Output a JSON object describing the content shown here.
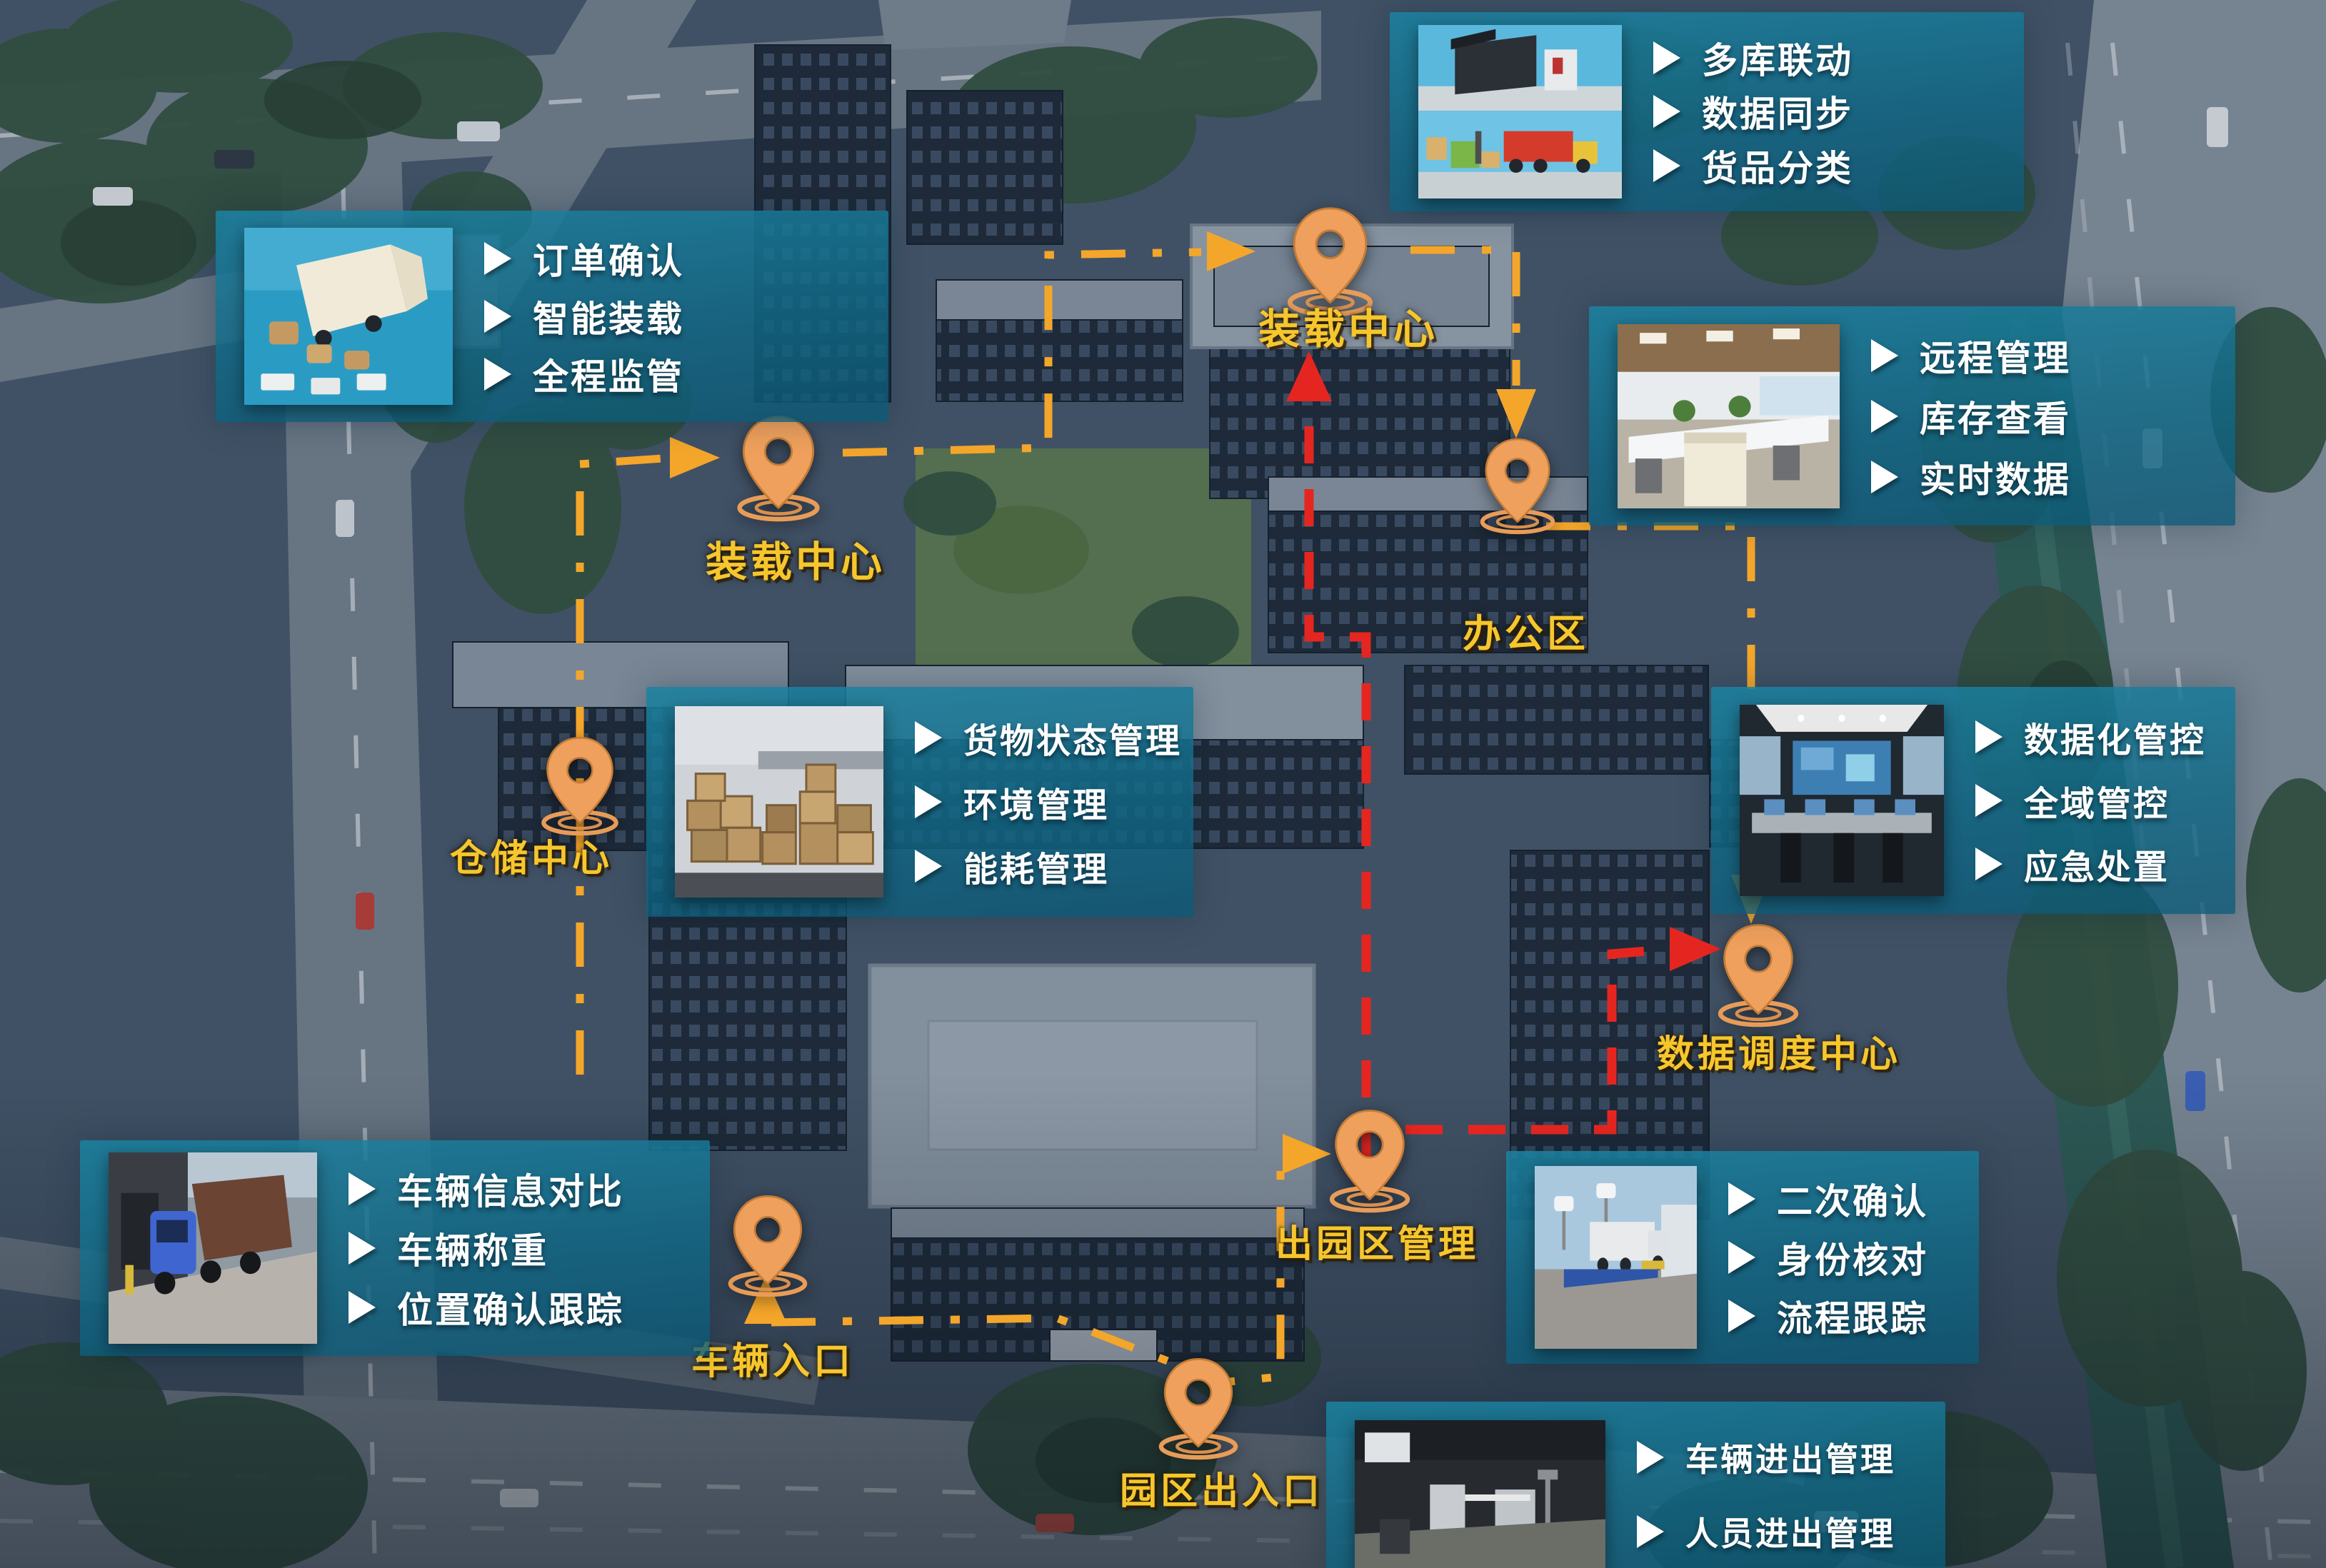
{
  "panels": [
    {
      "id": "order-confirm",
      "photo": "truck-loading-illustration",
      "items": [
        "订单确认",
        "智能装载",
        "全程监管"
      ]
    },
    {
      "id": "multi-warehouse",
      "photo": "warehouse-truck-illustration",
      "items": [
        "多库联动",
        "数据同步",
        "货品分类"
      ]
    },
    {
      "id": "remote-management",
      "photo": "office-interior-photo",
      "items": [
        "远程管理",
        "库存查看",
        "实时数据"
      ]
    },
    {
      "id": "cargo-status",
      "photo": "warehouse-boxes-photo",
      "items": [
        "货物状态管理",
        "环境管理",
        "能耗管理"
      ]
    },
    {
      "id": "data-control",
      "photo": "control-room-photo",
      "items": [
        "数据化管控",
        "全域管控",
        "应急处置"
      ]
    },
    {
      "id": "vehicle-check",
      "photo": "gate-truck-photo",
      "items": [
        "车辆信息对比",
        "车辆称重",
        "位置确认跟踪"
      ]
    },
    {
      "id": "exit-confirm",
      "photo": "weighbridge-photo",
      "items": [
        "二次确认",
        "身份核对",
        "流程跟踪"
      ]
    },
    {
      "id": "gate-management",
      "photo": "entrance-gate-photo",
      "items": [
        "车辆进出管理",
        "人员进出管理"
      ]
    }
  ],
  "pins": [
    {
      "id": "loading-center-top",
      "label": "装载中心"
    },
    {
      "id": "loading-center-left",
      "label": "装载中心"
    },
    {
      "id": "office-area",
      "label": "办公区"
    },
    {
      "id": "warehouse-center",
      "label": "仓储中心"
    },
    {
      "id": "data-dispatch-center",
      "label": "数据调度中心"
    },
    {
      "id": "exit-park-management",
      "label": "出园区管理"
    },
    {
      "id": "vehicle-entrance",
      "label": "车辆入口"
    },
    {
      "id": "park-gate",
      "label": "园区出入口"
    }
  ],
  "colors": {
    "panel_teal": "#11738f",
    "route_orange": "#f4a62a",
    "route_red": "#e52620",
    "pin_fill": "#efa05c",
    "label_yellow": "#f6c62d"
  }
}
